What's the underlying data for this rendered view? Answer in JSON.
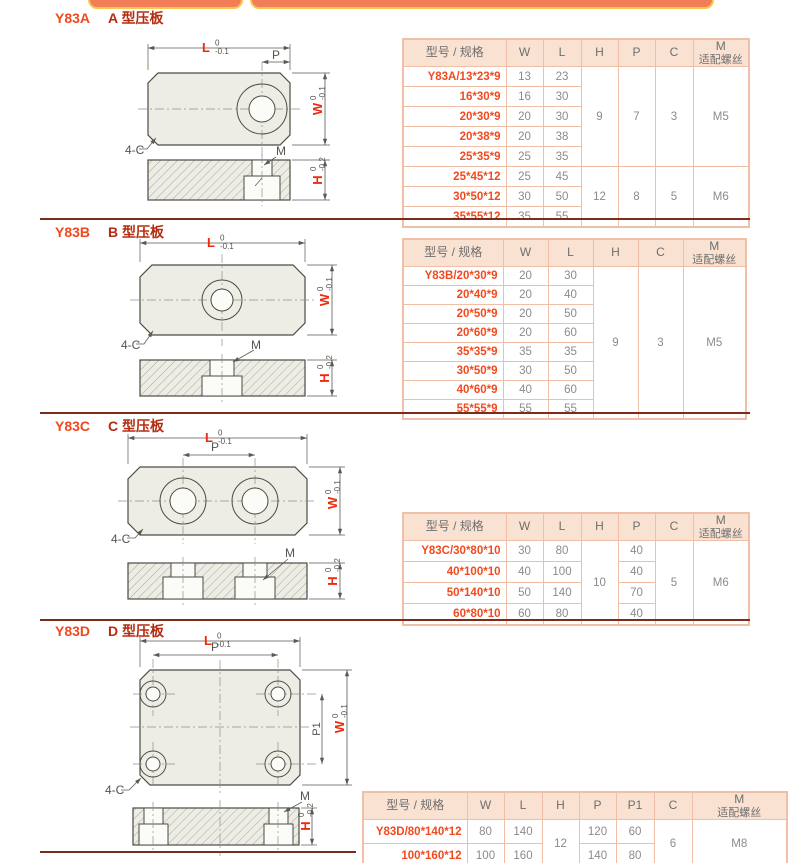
{
  "colors": {
    "accent_red": "#f1481f",
    "title_dark_red": "#b52c10",
    "table_border": "#f0bfa7",
    "table_header_bg": "#fae2d2",
    "value_gray": "#8b8b8b",
    "divider": "#7d2c1a",
    "tab_bar_fill": "#f17e57",
    "tab_bar_border": "#f6c84d"
  },
  "sections": [
    {
      "code": "Y83A",
      "type_label": "A 型压板",
      "drawing": {
        "l": "L",
        "l_tol_up": "0",
        "l_tol_dn": "-0.1",
        "p": "P",
        "w": "W",
        "w_tol_up": "0",
        "w_tol_dn": "-0.1",
        "h": "H",
        "h_tol_up": "0",
        "h_tol_dn": "-0.2",
        "m": "M",
        "chamfer": "4-C"
      },
      "table": {
        "columns": [
          {
            "key": "model",
            "label": "型号 / 规格",
            "width": 103
          },
          {
            "key": "W",
            "label": "W",
            "width": 37
          },
          {
            "key": "L",
            "label": "L",
            "width": 38
          },
          {
            "key": "H",
            "label": "H",
            "width": 37,
            "merged": true
          },
          {
            "key": "P",
            "label": "P",
            "width": 37,
            "merged": true
          },
          {
            "key": "C",
            "label": "C",
            "width": 38,
            "merged": true
          },
          {
            "key": "M",
            "label": "M",
            "label2": "适配螺丝",
            "width": 56,
            "merged": true
          }
        ],
        "rows": [
          {
            "model": "Y83A/13*23*9",
            "W": "13",
            "L": "23"
          },
          {
            "model": "16*30*9",
            "W": "16",
            "L": "30"
          },
          {
            "model": "20*30*9",
            "W": "20",
            "L": "30"
          },
          {
            "model": "20*38*9",
            "W": "20",
            "L": "38"
          },
          {
            "model": "25*35*9",
            "W": "25",
            "L": "35"
          },
          {
            "model": "25*45*12",
            "W": "25",
            "L": "45"
          },
          {
            "model": "30*50*12",
            "W": "30",
            "L": "50"
          },
          {
            "model": "35*55*12",
            "W": "35",
            "L": "55"
          }
        ],
        "merges": {
          "H": [
            {
              "start": 0,
              "span": 5,
              "value": "9"
            },
            {
              "start": 5,
              "span": 3,
              "value": "12"
            }
          ],
          "P": [
            {
              "start": 0,
              "span": 5,
              "value": "7"
            },
            {
              "start": 5,
              "span": 3,
              "value": "8"
            }
          ],
          "C": [
            {
              "start": 0,
              "span": 5,
              "value": "3"
            },
            {
              "start": 5,
              "span": 3,
              "value": "5"
            }
          ],
          "M": [
            {
              "start": 0,
              "span": 5,
              "value": "M5"
            },
            {
              "start": 5,
              "span": 3,
              "value": "M6"
            }
          ]
        }
      }
    },
    {
      "code": "Y83B",
      "type_label": "B 型压板",
      "drawing": {
        "l": "L",
        "l_tol_up": "0",
        "l_tol_dn": "-0.1",
        "w": "W",
        "w_tol_up": "0",
        "w_tol_dn": "-0.1",
        "h": "H",
        "h_tol_up": "0",
        "h_tol_dn": "-0.2",
        "m": "M",
        "chamfer": "4-C"
      },
      "table": {
        "columns": [
          {
            "key": "model",
            "label": "型号 / 规格",
            "width": 100
          },
          {
            "key": "W",
            "label": "W",
            "width": 45
          },
          {
            "key": "L",
            "label": "L",
            "width": 45
          },
          {
            "key": "H",
            "label": "H",
            "width": 45,
            "merged": true
          },
          {
            "key": "C",
            "label": "C",
            "width": 45,
            "merged": true
          },
          {
            "key": "M",
            "label": "M",
            "label2": "适配螺丝",
            "width": 63,
            "merged": true
          }
        ],
        "rows": [
          {
            "model": "Y83B/20*30*9",
            "W": "20",
            "L": "30"
          },
          {
            "model": "20*40*9",
            "W": "20",
            "L": "40"
          },
          {
            "model": "20*50*9",
            "W": "20",
            "L": "50"
          },
          {
            "model": "20*60*9",
            "W": "20",
            "L": "60"
          },
          {
            "model": "35*35*9",
            "W": "35",
            "L": "35"
          },
          {
            "model": "30*50*9",
            "W": "30",
            "L": "50"
          },
          {
            "model": "40*60*9",
            "W": "40",
            "L": "60"
          },
          {
            "model": "55*55*9",
            "W": "55",
            "L": "55"
          }
        ],
        "merges": {
          "H": [
            {
              "start": 0,
              "span": 8,
              "value": "9"
            }
          ],
          "C": [
            {
              "start": 0,
              "span": 8,
              "value": "3"
            }
          ],
          "M": [
            {
              "start": 0,
              "span": 8,
              "value": "M5"
            }
          ]
        }
      }
    },
    {
      "code": "Y83C",
      "type_label": "C 型压板",
      "drawing": {
        "l": "L",
        "l_tol_up": "0",
        "l_tol_dn": "-0.1",
        "p": "P",
        "w": "W",
        "w_tol_up": "0",
        "w_tol_dn": "-0.1",
        "h": "H",
        "h_tol_up": "0",
        "h_tol_dn": "-0.2",
        "m": "M",
        "chamfer": "4-C"
      },
      "table": {
        "columns": [
          {
            "key": "model",
            "label": "型号 / 规格",
            "width": 103
          },
          {
            "key": "W",
            "label": "W",
            "width": 37
          },
          {
            "key": "L",
            "label": "L",
            "width": 38
          },
          {
            "key": "H",
            "label": "H",
            "width": 37,
            "merged": true
          },
          {
            "key": "P",
            "label": "P",
            "width": 37
          },
          {
            "key": "C",
            "label": "C",
            "width": 38,
            "merged": true
          },
          {
            "key": "M",
            "label": "M",
            "label2": "适配螺丝",
            "width": 56,
            "merged": true
          }
        ],
        "rows": [
          {
            "model": "Y83C/30*80*10",
            "W": "30",
            "L": "80",
            "P": "40"
          },
          {
            "model": "40*100*10",
            "W": "40",
            "L": "100",
            "P": "40"
          },
          {
            "model": "50*140*10",
            "W": "50",
            "L": "140",
            "P": "70"
          },
          {
            "model": "60*80*10",
            "W": "60",
            "L": "80",
            "P": "40"
          }
        ],
        "merges": {
          "H": [
            {
              "start": 0,
              "span": 4,
              "value": "10"
            }
          ],
          "C": [
            {
              "start": 0,
              "span": 4,
              "value": "5"
            }
          ],
          "M": [
            {
              "start": 0,
              "span": 4,
              "value": "M6"
            }
          ]
        }
      }
    },
    {
      "code": "Y83D",
      "type_label": "D 型压板",
      "drawing": {
        "l": "L",
        "l_tol_up": "0",
        "l_tol_dn": "-0.1",
        "p": "P",
        "p1": "P1",
        "w": "W",
        "w_tol_up": "0",
        "w_tol_dn": "-0.1",
        "h": "H",
        "h_tol_up": "0",
        "h_tol_dn": "-0.2",
        "m": "M",
        "chamfer": "4-C"
      },
      "table": {
        "columns": [
          {
            "key": "model",
            "label": "型号 / 规格",
            "width": 104
          },
          {
            "key": "W",
            "label": "W",
            "width": 37
          },
          {
            "key": "L",
            "label": "L",
            "width": 38
          },
          {
            "key": "H",
            "label": "H",
            "width": 37,
            "merged": true
          },
          {
            "key": "P",
            "label": "P",
            "width": 37
          },
          {
            "key": "P1",
            "label": "P1",
            "width": 38
          },
          {
            "key": "C",
            "label": "C",
            "width": 38,
            "merged": true
          },
          {
            "key": "M",
            "label": "M",
            "label2": "适配螺丝",
            "width": 95,
            "merged": true
          }
        ],
        "rows": [
          {
            "model": "Y83D/80*140*12",
            "W": "80",
            "L": "140",
            "P": "120",
            "P1": "60"
          },
          {
            "model": "100*160*12",
            "W": "100",
            "L": "160",
            "P": "140",
            "P1": "80"
          }
        ],
        "merges": {
          "H": [
            {
              "start": 0,
              "span": 2,
              "value": "12"
            }
          ],
          "C": [
            {
              "start": 0,
              "span": 2,
              "value": "6"
            }
          ],
          "M": [
            {
              "start": 0,
              "span": 2,
              "value": "M8"
            }
          ]
        }
      }
    }
  ]
}
